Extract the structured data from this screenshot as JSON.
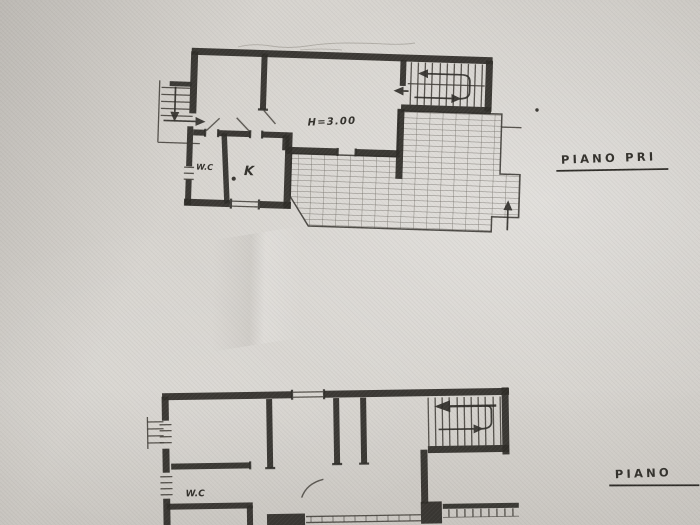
{
  "labels": {
    "upper_floor_title": "PIANO PRI",
    "lower_floor_title": "PIANO",
    "ceiling_height": "H=3.00",
    "upper_wc": "W.C",
    "upper_kitchen": "K",
    "lower_wc": "W.C"
  },
  "colors": {
    "paper": "#d7d4cf",
    "ink": "#2e2c28"
  }
}
